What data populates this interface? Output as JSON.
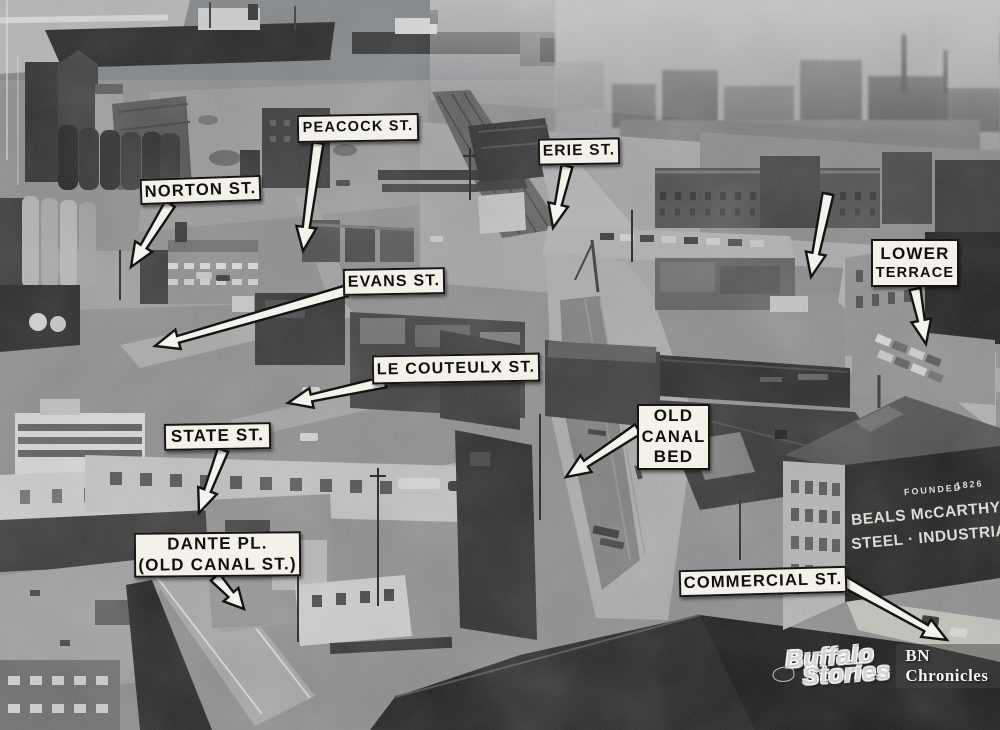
{
  "photo": {
    "watermark": {
      "logo_line1": "Buffalo",
      "logo_line2": "Stories",
      "caption": "BN Chronicles"
    },
    "building_sign": {
      "founded": "FOUNDED",
      "year": "1826",
      "name": "BEALS McCARTHY & RO",
      "products": "STEEL · INDUSTRIAL SUP"
    }
  },
  "annotations": [
    {
      "id": "norton-st",
      "lines": [
        "NORTON ST."
      ],
      "box": {
        "x": 140,
        "y": 177,
        "w": 121,
        "h": 26,
        "rot": -2
      },
      "arrows": [
        {
          "tail": [
            170,
            204
          ],
          "tip": [
            131,
            267
          ]
        }
      ]
    },
    {
      "id": "peacock-st",
      "lines": [
        "PEACOCK ST."
      ],
      "box": {
        "x": 297,
        "y": 114,
        "w": 122,
        "h": 28,
        "rot": -1
      },
      "arrows": [
        {
          "tail": [
            318,
            143
          ],
          "tip": [
            303,
            251
          ]
        }
      ]
    },
    {
      "id": "erie-st",
      "lines": [
        "ERIE ST."
      ],
      "box": {
        "x": 538,
        "y": 138,
        "w": 82,
        "h": 27,
        "rot": -1
      },
      "arrows": [
        {
          "tail": [
            567,
            166
          ],
          "tip": [
            553,
            228
          ]
        }
      ]
    },
    {
      "id": "evans-st",
      "lines": [
        "EVANS ST."
      ],
      "box": {
        "x": 343,
        "y": 268,
        "w": 102,
        "h": 27,
        "rot": -1
      },
      "arrows": [
        {
          "tail": [
            346,
            291
          ],
          "tip": [
            155,
            346
          ]
        }
      ]
    },
    {
      "id": "le-couteulx-st",
      "lines": [
        "LE COUTEULX ST."
      ],
      "box": {
        "x": 372,
        "y": 354,
        "w": 168,
        "h": 29,
        "rot": -1
      },
      "arrows": [
        {
          "tail": [
            385,
            382
          ],
          "tip": [
            288,
            403
          ]
        }
      ]
    },
    {
      "id": "state-st",
      "lines": [
        "STATE ST."
      ],
      "box": {
        "x": 164,
        "y": 423,
        "w": 107,
        "h": 27,
        "rot": -1
      },
      "arrows": [
        {
          "tail": [
            223,
            450
          ],
          "tip": [
            199,
            513
          ]
        }
      ]
    },
    {
      "id": "dante-pl",
      "lines": [
        "DANTE PL.",
        "(OLD CANAL ST.)"
      ],
      "box": {
        "x": 134,
        "y": 532,
        "w": 167,
        "h": 45,
        "rot": -0.5
      },
      "arrows": [
        {
          "tail": [
            215,
            577
          ],
          "tip": [
            244,
            609
          ]
        }
      ]
    },
    {
      "id": "old-canal-bed",
      "lines": [
        "OLD",
        "CANAL",
        "BED"
      ],
      "box": {
        "x": 637,
        "y": 404,
        "w": 73,
        "h": 66,
        "rot": 0
      },
      "arrows": [
        {
          "tail": [
            638,
            429
          ],
          "tip": [
            566,
            477
          ]
        }
      ]
    },
    {
      "id": "lower-terrace",
      "lines": [
        "LOWER",
        "TERRACE"
      ],
      "box": {
        "x": 871,
        "y": 239,
        "w": 88,
        "h": 48,
        "rot": 0
      },
      "arrows": [
        {
          "tail": [
            915,
            289
          ],
          "tip": [
            926,
            344
          ]
        }
      ]
    },
    {
      "id": "unlabeled",
      "lines": [],
      "arrows": [
        {
          "tail": [
            828,
            194
          ],
          "tip": [
            811,
            277
          ]
        }
      ]
    },
    {
      "id": "commercial-st",
      "lines": [
        "COMMERCIAL ST."
      ],
      "box": {
        "x": 679,
        "y": 568,
        "w": 168,
        "h": 27,
        "rot": -1.5
      },
      "arrows": [
        {
          "tail": [
            843,
            581
          ],
          "tip": [
            947,
            640
          ]
        }
      ]
    }
  ]
}
